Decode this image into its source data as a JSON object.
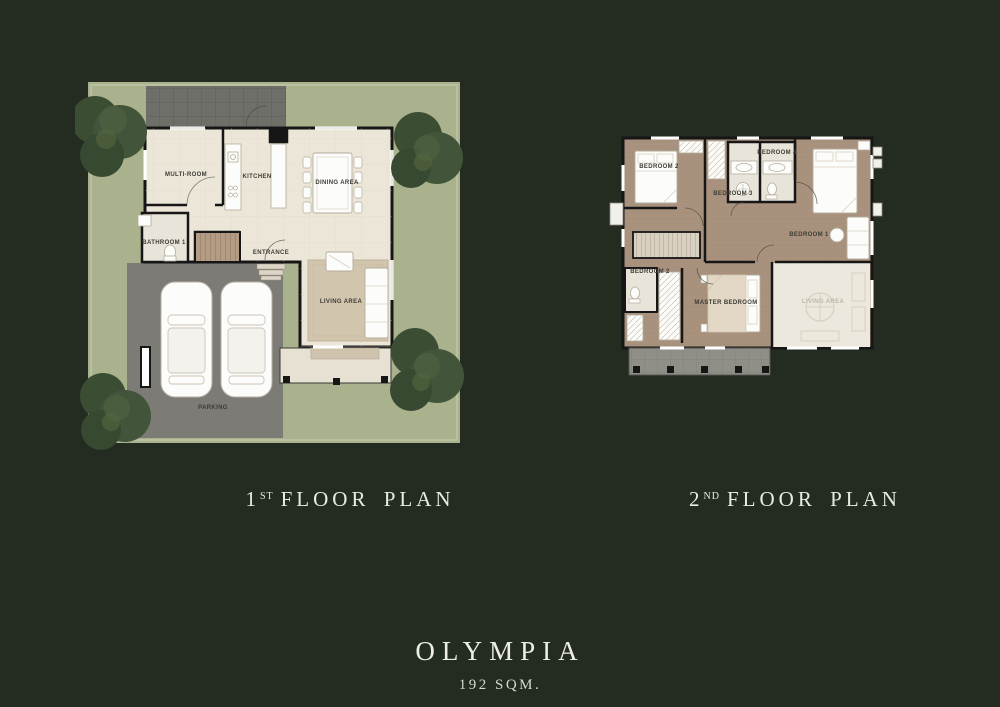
{
  "model": {
    "name": "OLYMPIA",
    "area": "192 SQM."
  },
  "captions": {
    "floor1": {
      "number": "1",
      "ordinal": "ST",
      "rest": "FLOOR PLAN"
    },
    "floor2": {
      "number": "2",
      "ordinal": "ND",
      "rest": "FLOOR PLAN"
    }
  },
  "floor1": {
    "labels": {
      "multi_room": "MULTI-ROOM",
      "kitchen": "KITCHEN",
      "dining_area": "DINING AREA",
      "bathroom_1": "BATHROOM 1",
      "entrance": "ENTRANCE",
      "living_area": "LIVING AREA",
      "parking": "PARKING"
    }
  },
  "floor2": {
    "labels": {
      "bedroom_2_upper": "BEDROOM 2",
      "bath_center": "BEDROOM 3",
      "bath_right": "BEDROOM 4",
      "bedroom_1": "BEDROOM 1",
      "bath_lower": "BEDROOM 2",
      "master_bedroom": "MASTER BEDROOM",
      "living_void": "LIVING AREA"
    }
  },
  "colors": {
    "background": "#242b21",
    "lawn": "#a9b28c",
    "tree_foliage": "#3b4d32",
    "paving": "#6f6f69",
    "driveway": "#7c7b75",
    "interior_floor": "#ece6d8",
    "wood_floor": "#a8927d",
    "bath_floor": "#e9e4da",
    "wall": "#161616",
    "furniture": "#fcfcfa",
    "caption_text": "#e9ebe1",
    "room_label_text": "#3e3c34"
  }
}
